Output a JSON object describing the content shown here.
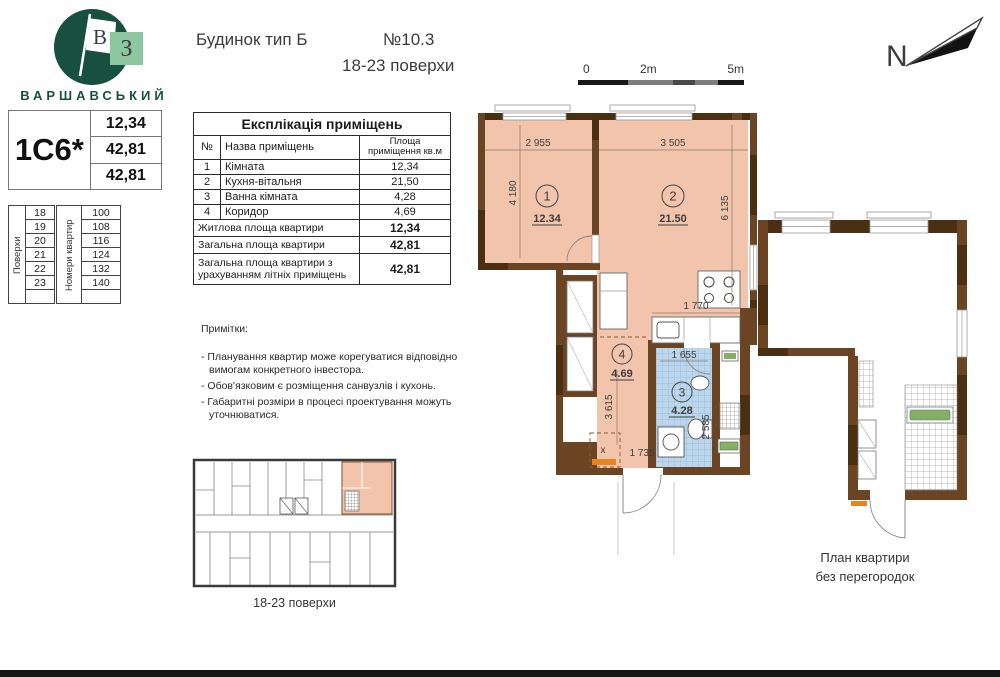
{
  "logo": {
    "brand": "ВАРШАВСЬКИЙ",
    "flag_letter": "В",
    "square_letter": "З"
  },
  "header": {
    "building_type": "Будинок тип Б",
    "plan_number": "№10.3",
    "floors_range": "18-23 поверхи"
  },
  "apartment_card": {
    "code": "1С6*",
    "living_area": "12,34",
    "total_area": "42,81",
    "total_area_summer": "42,81"
  },
  "floors_table": {
    "label": "Поверхи",
    "floors": [
      "18",
      "19",
      "20",
      "21",
      "22",
      "23"
    ]
  },
  "apartment_numbers_table": {
    "label": "Номери квартир",
    "numbers": [
      "100",
      "108",
      "116",
      "124",
      "132",
      "140"
    ]
  },
  "explication": {
    "title": "Експлікація приміщень",
    "col_no": "№",
    "col_name": "Назва приміщень",
    "col_area": "Площа приміщення кв.м",
    "rooms": [
      {
        "no": "1",
        "name": "Кімната",
        "area": "12,34"
      },
      {
        "no": "2",
        "name": "Кухня-вітальня",
        "area": "21,50"
      },
      {
        "no": "3",
        "name": "Ванна кімната",
        "area": "4,28"
      },
      {
        "no": "4",
        "name": "Коридор",
        "area": "4,69"
      }
    ],
    "summary": [
      {
        "label": "Житлова площа квартири",
        "value": "12,34"
      },
      {
        "label": "Загальна площа квартири",
        "value": "42,81"
      },
      {
        "label": "Загальна площа квартири з урахуванням літніх приміщень",
        "value": "42,81"
      }
    ]
  },
  "notes": {
    "title": "Примітки:",
    "items": [
      "- Планування квартир може корегуватися відповідно вимогам конкретного інвестора.",
      "- Обов'язковим є розміщення санвузлів і кухонь.",
      "- Габаритні розміри в процесі проектування можуть уточнюватися."
    ]
  },
  "mini_plan": {
    "caption": "18-23 поверхи"
  },
  "compass": {
    "label": "N"
  },
  "scale_bar": {
    "zero": "0",
    "two": "2m",
    "five": "5m"
  },
  "main_plan": {
    "rooms": [
      {
        "num": "1",
        "area": "12.34"
      },
      {
        "num": "2",
        "area": "21.50"
      },
      {
        "num": "3",
        "area": "4.28"
      },
      {
        "num": "4",
        "area": "4.69"
      }
    ],
    "dims": {
      "room1_width": "2 955",
      "room2_width": "3 505",
      "room1_height": "4 180",
      "room2_height": "6 135",
      "kitchen": "1 770",
      "bath_width": "1 655",
      "hall_height": "3 615",
      "bath_height": "2 585",
      "entry_width": "1 735"
    },
    "entry_mark": "х"
  },
  "right_plan": {
    "caption_line1": "План квартири",
    "caption_line2": "без перегородок"
  },
  "colors": {
    "brand_green": "#17503f",
    "brand_light_green": "#8cc7a1",
    "room_fill": "#f2c4ab",
    "wall_brown": "#6b4423",
    "wall_dark": "#4a2f12",
    "tile_blue": "#bcd6ec",
    "accent_orange": "#e8831e"
  }
}
